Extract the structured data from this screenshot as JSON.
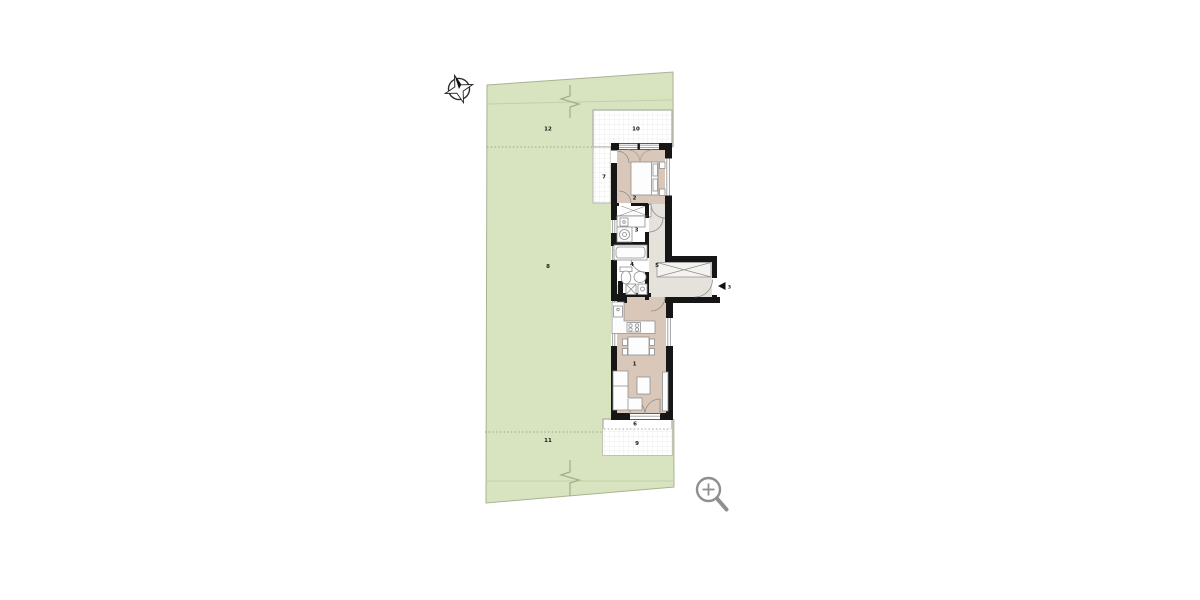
{
  "scene": "residential-site-and-floor-plan",
  "labels": {
    "living": "1",
    "bedroom": "2",
    "laundry": "3",
    "bathroom": "4",
    "hallway": "5",
    "terrace_south": "6",
    "walkway_west": "7",
    "garden_main": "8",
    "patio_south": "9",
    "terrace_north": "10",
    "garden_south": "11",
    "garden_north": "12",
    "entry": "3"
  },
  "colors": {
    "site_green": "#d8e4c0",
    "site_border": "#a9b292",
    "floor_tan": "#d9c8ba",
    "floor_gray": "#e5e2dc",
    "wall": "#161616",
    "terrace_border": "#b5b5ad",
    "grid_line": "#e6e6e4",
    "icon_gray": "#8f8f8f"
  },
  "icons": {
    "compass": "compass-rose",
    "zoom": "magnifier-plus"
  }
}
